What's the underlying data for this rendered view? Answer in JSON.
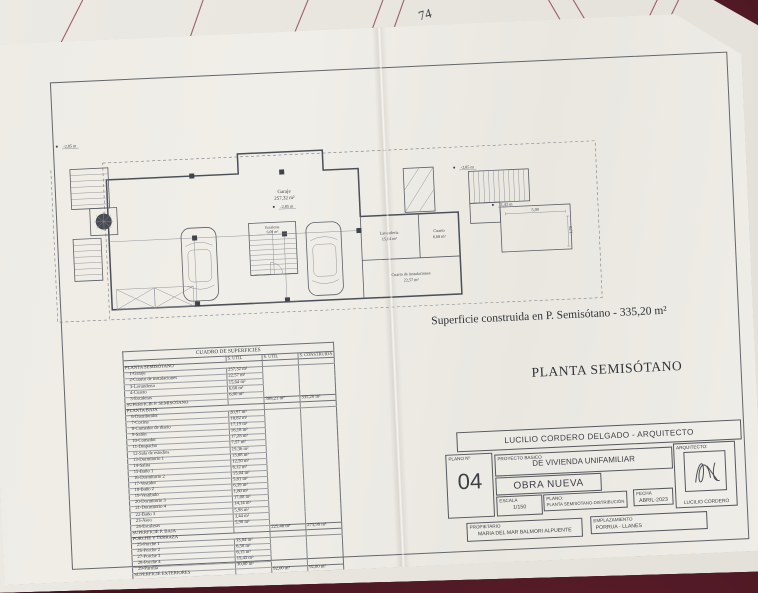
{
  "back_sheet": {
    "page_number": "74"
  },
  "plan": {
    "title": "PLANTA SEMISÓTANO",
    "subtitle": "Superficie construida en P. Semisótano - 335,20 m²",
    "labels": {
      "garaje_name": "Garaje",
      "garaje_area": "257,32 m²",
      "escaleras_name": "Escaleras",
      "escaleras_area": "6,00 m²",
      "lavanderia_name": "Lavandería",
      "lavanderia_area": "15,64 m²",
      "cuarto_name": "Cuarto",
      "cuarto_area": "6,68 m²",
      "instalaciones_name": "Cuarto de instalaciones",
      "instalaciones_area": "22,57 m²"
    },
    "level_markers": {
      "left": "-2,85 m",
      "garage": "-2,85 m",
      "stair_top": "-2,85 m",
      "stair_mid": "-1,42 m"
    },
    "dimensions": {
      "terrace_width": "5,00",
      "terrace_height": "1,79"
    }
  },
  "surface_table": {
    "title": "CUADRO DE SUPERFICIES",
    "columns": [
      "S. UTIL",
      "S. UTIL",
      "S. CONSTRUIDA"
    ],
    "sections": [
      {
        "header": "PLANTA SEMISÓTANO",
        "rows": [
          [
            "1-Garaje",
            "257,32 m²"
          ],
          [
            "2-Cuarto de instalaciones",
            "22,57 m²"
          ],
          [
            "3-Lavandería",
            "15,64 m²"
          ],
          [
            "4-Cuarto",
            "6,68 m²"
          ],
          [
            "5-Escaleras",
            "6,00 m²"
          ]
        ],
        "total": {
          "label": "SUPERFICIE P. SEMISÓTANO",
          "s_util": "308,21 m²",
          "construida": "335,20 m²"
        }
      },
      {
        "header": "PLANTA BAJA",
        "rows": [
          [
            "6-Distribuidor",
            "20,97 m²"
          ],
          [
            "7-Cocina",
            "18,82 m²"
          ],
          [
            "8-Comedor de diario",
            "17,19 m²"
          ],
          [
            "9-Salón",
            "16,18 m²"
          ],
          [
            "10-Comedor",
            "17,28 m²"
          ],
          [
            "11-Despacho",
            "7,57 m²"
          ],
          [
            "12-Sala de estudios",
            "19,36 m²"
          ],
          [
            "13-Dormitorio 1",
            "13,88 m²"
          ],
          [
            "14-Salita",
            "12,50 m²"
          ],
          [
            "15-Baño 1",
            "6,12 m²"
          ],
          [
            "16-Dormitorio 2",
            "15,04 m²"
          ],
          [
            "17-Vestidor",
            "5,81 m²"
          ],
          [
            "18-Baño 2",
            "6,39 m²"
          ],
          [
            "19-Vestíbulo",
            "1,80 m²"
          ],
          [
            "20-Dormitorio 3",
            "17,08 m²"
          ],
          [
            "21-Dormitorio 4",
            "14,14 m²"
          ],
          [
            "22-Baño 3",
            "5,98 m²"
          ],
          [
            "23-Aseo",
            "3,44 m²"
          ],
          [
            "24-Escaleras",
            "5,90 m²"
          ]
        ],
        "total": {
          "label": "SUPERFICIE P. BAJA",
          "s_util": "225,40 m²",
          "construida": "273,99 m²"
        }
      },
      {
        "header": "PORCHE Y TERRAZA",
        "rows": [
          [
            "25-Porche 1",
            "33,84 m²"
          ],
          [
            "26-Porche 2",
            "6,58 m²"
          ],
          [
            "27-Porche 3",
            "6,15 m²"
          ],
          [
            "28-Porche 4",
            "15,43 m²"
          ],
          [
            "29-Parrilla",
            "30,00 m²"
          ]
        ],
        "total": {
          "label": "SUPERFICIE EXTERIORES",
          "s_util": "92,00 m²",
          "construida": "92,00 m²"
        }
      }
    ]
  },
  "title_block": {
    "firm": "LUCILIO CORDERO DELGADO - ARQUITECTO",
    "plano_label": "PLANO Nº",
    "plano_number": "04",
    "proyecto_label": "PROYECTO BASICO",
    "proyecto_value": "DE VIVIENDA UNIFAMILIAR",
    "obra": "OBRA NUEVA",
    "escala_label": "ESCALA",
    "escala_value": "1/150",
    "plano_title_label": "PLANO:",
    "plano_title_value": "PLANTA SEMISÓTANO-DISTRIBUCIÓN",
    "fecha_label": "FECHA",
    "fecha_value": "ABRIL-2023",
    "arquitecto_label": "ARQUITECTO:",
    "arquitecto_name": "LUCILIO CORDERO",
    "propietario_label": "PROPIETARIO",
    "propietario_value": "MARIA DEL MAR BALMORI ALPUENTE",
    "emplazamiento_label": "EMPLAZAMIENTO",
    "emplazamiento_value": "PORRUA - LLANES"
  }
}
